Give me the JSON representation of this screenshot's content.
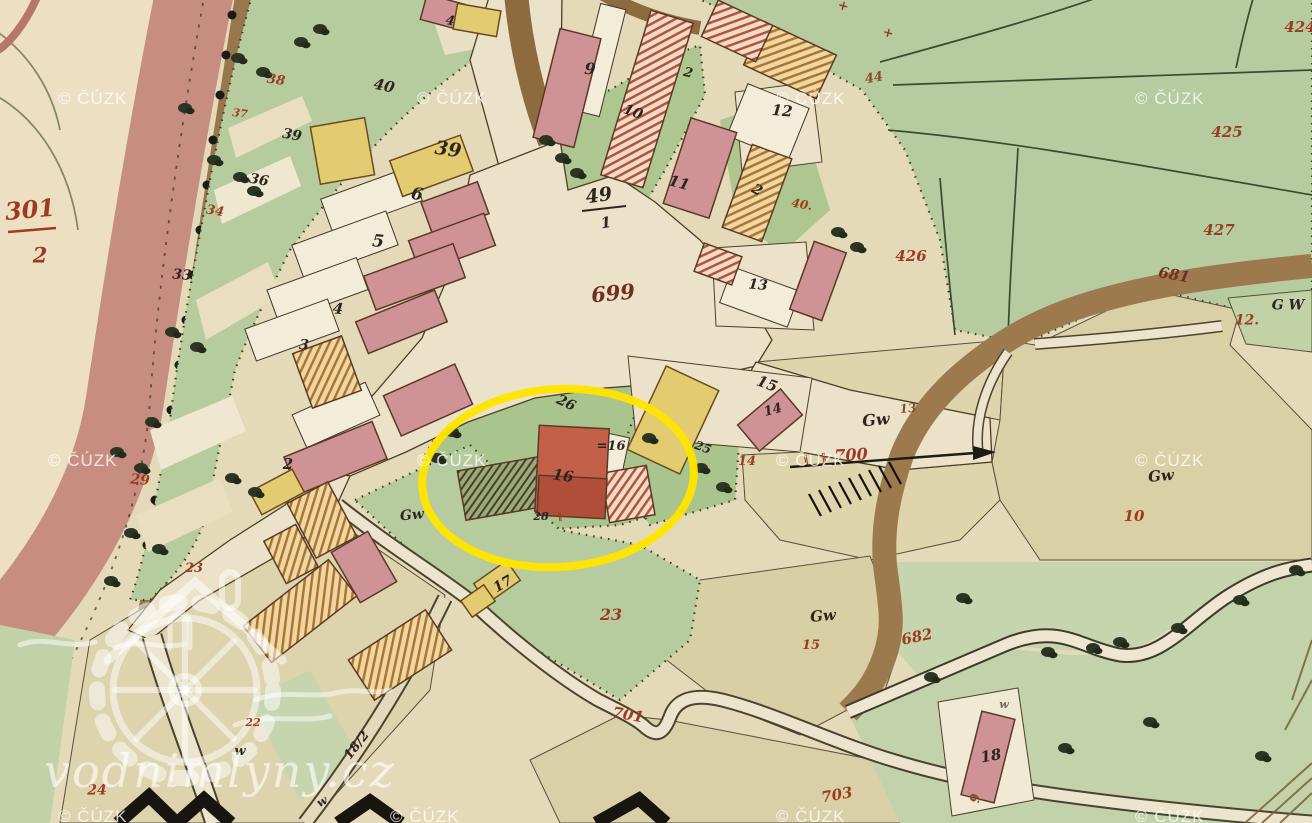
{
  "map": {
    "kind": "historical cadastral map scan",
    "highlight_note": "yellow ellipse around farmstead no. 16"
  },
  "annotation": {
    "shape": "ellipse",
    "color": "#ffe400"
  },
  "palette": {
    "red": "#9d3b22",
    "dark": "#2d2620",
    "brown": "#7a4a20",
    "rust": "#8a4f28",
    "dred": "#703021",
    "wgray": "#6f6a5e"
  },
  "watermarks": {
    "text": "© ČÚZK",
    "site_text": "vodnimlyny.cz",
    "positions": [
      [
        58,
        89
      ],
      [
        417,
        89
      ],
      [
        776,
        89
      ],
      [
        1135,
        89
      ],
      [
        48,
        451
      ],
      [
        417,
        451
      ],
      [
        776,
        451
      ],
      [
        1135,
        451
      ],
      [
        58,
        807
      ],
      [
        390,
        807
      ],
      [
        776,
        807
      ],
      [
        1135,
        807
      ]
    ]
  },
  "labels": [
    {
      "t": "301",
      "x": 30,
      "y": 211,
      "s": 24,
      "r": -5,
      "c": "red"
    },
    {
      "t": "2",
      "x": 40,
      "y": 256,
      "s": 21,
      "r": 0,
      "c": "red"
    },
    {
      "t": "38",
      "x": 276,
      "y": 81,
      "s": 13,
      "r": 8,
      "c": "red"
    },
    {
      "t": "37",
      "x": 240,
      "y": 114,
      "s": 11,
      "r": 8,
      "c": "red"
    },
    {
      "t": "34",
      "x": 215,
      "y": 212,
      "s": 13,
      "r": 10,
      "c": "red"
    },
    {
      "t": "29",
      "x": 140,
      "y": 481,
      "s": 14,
      "r": 5,
      "c": "red"
    },
    {
      "t": "23",
      "x": 194,
      "y": 569,
      "s": 13,
      "r": 0,
      "c": "red"
    },
    {
      "t": "22",
      "x": 253,
      "y": 723,
      "s": 11,
      "r": 0,
      "c": "red"
    },
    {
      "t": "24",
      "x": 97,
      "y": 791,
      "s": 14,
      "r": 0,
      "c": "red"
    },
    {
      "t": "23",
      "x": 611,
      "y": 616,
      "s": 16,
      "r": 0,
      "c": "red"
    },
    {
      "t": "701",
      "x": 628,
      "y": 716,
      "s": 15,
      "r": 10,
      "c": "red"
    },
    {
      "t": "703",
      "x": 837,
      "y": 796,
      "s": 15,
      "r": -10,
      "c": "red"
    },
    {
      "t": "682",
      "x": 917,
      "y": 638,
      "s": 15,
      "r": -12,
      "c": "red"
    },
    {
      "t": "700",
      "x": 851,
      "y": 456,
      "s": 16,
      "r": -3,
      "c": "red"
    },
    {
      "t": "‖",
      "x": 806,
      "y": 461,
      "s": 10,
      "r": -10,
      "c": "red"
    },
    {
      "t": "‖",
      "x": 824,
      "y": 459,
      "s": 10,
      "r": -10,
      "c": "red"
    },
    {
      "t": "14",
      "x": 747,
      "y": 462,
      "s": 13,
      "r": 0,
      "c": "red"
    },
    {
      "t": "15",
      "x": 811,
      "y": 646,
      "s": 13,
      "r": 0,
      "c": "red"
    },
    {
      "t": "10",
      "x": 1134,
      "y": 517,
      "s": 15,
      "r": 0,
      "c": "red"
    },
    {
      "t": "12.",
      "x": 1247,
      "y": 321,
      "s": 14,
      "r": 0,
      "c": "red"
    },
    {
      "t": "426",
      "x": 911,
      "y": 257,
      "s": 15,
      "r": 0,
      "c": "red"
    },
    {
      "t": "425",
      "x": 1227,
      "y": 133,
      "s": 15,
      "r": 0,
      "c": "red"
    },
    {
      "t": "427",
      "x": 1219,
      "y": 231,
      "s": 15,
      "r": 0,
      "c": "red"
    },
    {
      "t": "424",
      "x": 1300,
      "y": 28,
      "s": 15,
      "r": 0,
      "c": "red"
    },
    {
      "t": "681",
      "x": 1174,
      "y": 276,
      "s": 15,
      "r": 10,
      "c": "dred"
    },
    {
      "t": "44",
      "x": 874,
      "y": 79,
      "s": 13,
      "r": -10,
      "c": "rust"
    },
    {
      "t": "40.",
      "x": 802,
      "y": 205,
      "s": 12,
      "r": 10,
      "c": "red"
    },
    {
      "t": "+",
      "x": 843,
      "y": 7,
      "s": 13,
      "r": 15,
      "c": "red"
    },
    {
      "t": "+",
      "x": 888,
      "y": 34,
      "s": 13,
      "r": 15,
      "c": "red"
    },
    {
      "t": "40",
      "x": 384,
      "y": 87,
      "s": 15,
      "r": 12,
      "c": "dark"
    },
    {
      "t": "39",
      "x": 292,
      "y": 136,
      "s": 14,
      "r": 10,
      "c": "dark"
    },
    {
      "t": "36",
      "x": 259,
      "y": 181,
      "s": 14,
      "r": 10,
      "c": "dark"
    },
    {
      "t": "33",
      "x": 182,
      "y": 276,
      "s": 14,
      "r": 5,
      "c": "dark"
    },
    {
      "t": "39",
      "x": 448,
      "y": 151,
      "s": 19,
      "r": 8,
      "c": "dark"
    },
    {
      "t": "6",
      "x": 417,
      "y": 196,
      "s": 17,
      "r": 10,
      "c": "dark"
    },
    {
      "t": "5",
      "x": 378,
      "y": 243,
      "s": 17,
      "r": 5,
      "c": "dark"
    },
    {
      "t": "4",
      "x": 338,
      "y": 310,
      "s": 15,
      "r": 5,
      "c": "dark"
    },
    {
      "t": "3",
      "x": 304,
      "y": 346,
      "s": 14,
      "r": 5,
      "c": "dark"
    },
    {
      "t": "2",
      "x": 288,
      "y": 465,
      "s": 15,
      "r": 0,
      "c": "dark"
    },
    {
      "t": "9",
      "x": 590,
      "y": 70,
      "s": 16,
      "r": 5,
      "c": "dark"
    },
    {
      "t": "10",
      "x": 633,
      "y": 113,
      "s": 14,
      "r": 20,
      "c": "dark"
    },
    {
      "t": "11",
      "x": 679,
      "y": 184,
      "s": 15,
      "r": 15,
      "c": "dark"
    },
    {
      "t": "12",
      "x": 782,
      "y": 112,
      "s": 15,
      "r": 5,
      "c": "dark"
    },
    {
      "t": "2",
      "x": 688,
      "y": 74,
      "s": 13,
      "r": 15,
      "c": "dark"
    },
    {
      "t": "2",
      "x": 757,
      "y": 191,
      "s": 14,
      "r": 30,
      "c": "dark"
    },
    {
      "t": "4",
      "x": 450,
      "y": 22,
      "s": 13,
      "r": 10,
      "c": "dark"
    },
    {
      "t": "13",
      "x": 758,
      "y": 286,
      "s": 14,
      "r": 5,
      "c": "dark"
    },
    {
      "t": "699",
      "x": 613,
      "y": 294,
      "s": 21,
      "r": -5,
      "c": "dred"
    },
    {
      "t": "49",
      "x": 599,
      "y": 197,
      "s": 19,
      "r": -8,
      "c": "dark"
    },
    {
      "t": "1",
      "x": 606,
      "y": 224,
      "s": 15,
      "r": -8,
      "c": "dark"
    },
    {
      "t": "15",
      "x": 767,
      "y": 385,
      "s": 15,
      "r": 20,
      "c": "dark"
    },
    {
      "t": "16",
      "x": 563,
      "y": 477,
      "s": 15,
      "r": 8,
      "c": "dark"
    },
    {
      "t": "=16",
      "x": 611,
      "y": 447,
      "s": 13,
      "r": 0,
      "c": "dark"
    },
    {
      "t": "26",
      "x": 566,
      "y": 404,
      "s": 14,
      "r": 25,
      "c": "dark"
    },
    {
      "t": "25",
      "x": 703,
      "y": 448,
      "s": 12,
      "r": 20,
      "c": "dark"
    },
    {
      "t": "14",
      "x": 773,
      "y": 411,
      "s": 13,
      "r": -15,
      "c": "dark"
    },
    {
      "t": "28",
      "x": 541,
      "y": 517,
      "s": 11,
      "r": 0,
      "c": "dark"
    },
    {
      "t": "‖",
      "x": 560,
      "y": 518,
      "s": 9,
      "r": -10,
      "c": "red"
    },
    {
      "t": "17",
      "x": 503,
      "y": 585,
      "s": 14,
      "r": -30,
      "c": "dark"
    },
    {
      "t": "18",
      "x": 991,
      "y": 757,
      "s": 15,
      "r": -10,
      "c": "dark"
    },
    {
      "t": "9",
      "x": 976,
      "y": 799,
      "s": 13,
      "r": -80,
      "c": "rust"
    },
    {
      "t": "Gw",
      "x": 412,
      "y": 516,
      "s": 14,
      "r": -5,
      "c": "dark"
    },
    {
      "t": "Gw",
      "x": 876,
      "y": 421,
      "s": 16,
      "r": -5,
      "c": "dark"
    },
    {
      "t": "13",
      "x": 908,
      "y": 409,
      "s": 12,
      "r": -5,
      "c": "rust"
    },
    {
      "t": "Gw",
      "x": 823,
      "y": 617,
      "s": 15,
      "r": -5,
      "c": "dark"
    },
    {
      "t": "Gw",
      "x": 1161,
      "y": 477,
      "s": 15,
      "r": -5,
      "c": "dark"
    },
    {
      "t": "G W",
      "x": 1288,
      "y": 306,
      "s": 14,
      "r": 0,
      "c": "dark"
    },
    {
      "t": "w",
      "x": 240,
      "y": 752,
      "s": 13,
      "r": 0,
      "c": "dark"
    },
    {
      "t": "w",
      "x": 322,
      "y": 802,
      "s": 12,
      "r": -30,
      "c": "dark"
    },
    {
      "t": "18/2",
      "x": 357,
      "y": 746,
      "s": 13,
      "r": -52,
      "c": "dark"
    },
    {
      "t": "w",
      "x": 1004,
      "y": 705,
      "s": 11,
      "r": 0,
      "c": "wgray"
    }
  ]
}
